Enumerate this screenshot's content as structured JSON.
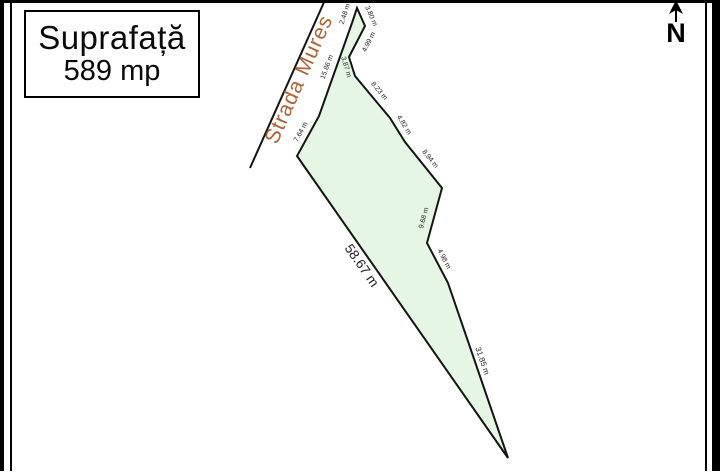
{
  "surface_box": {
    "title": "Suprafață",
    "value": "589 mp"
  },
  "street": {
    "name": "Strada Mures",
    "color": "#b06133",
    "line": {
      "x1": 250,
      "y1": 168,
      "x2": 325,
      "y2": 0
    },
    "label_pos": {
      "x": 305,
      "y": 82,
      "rot": -66,
      "size": 21
    }
  },
  "north_arrow": {
    "label": "N"
  },
  "parcel": {
    "fill": "#e5f7e4",
    "stroke": "#141414",
    "points": "357,8 365,26 349,57 355,76 390,118 405,142 442,188 427,243 448,283 508,458 297,156 319,116 352,23",
    "label_color": "#1c1c1c",
    "edge_labels": [
      {
        "text": "2.48 m",
        "x": 345,
        "y": 14,
        "rot": -72,
        "size": 7
      },
      {
        "text": "3.80 m",
        "x": 371,
        "y": 16,
        "rot": 66,
        "size": 7
      },
      {
        "text": "4.99 m",
        "x": 369,
        "y": 42,
        "rot": -63,
        "size": 7
      },
      {
        "text": "3.87 m",
        "x": 346,
        "y": 67,
        "rot": 73,
        "size": 7
      },
      {
        "text": "15.86 m",
        "x": 327,
        "y": 67,
        "rot": -70,
        "size": 7
      },
      {
        "text": "7.64 m",
        "x": 301,
        "y": 132,
        "rot": -61,
        "size": 7
      },
      {
        "text": "8.23 m",
        "x": 379,
        "y": 91,
        "rot": 50,
        "size": 7
      },
      {
        "text": "4.82 m",
        "x": 404,
        "y": 125,
        "rot": 58,
        "size": 7
      },
      {
        "text": "8.94 m",
        "x": 430,
        "y": 159,
        "rot": 51,
        "size": 7
      },
      {
        "text": "9.68 m",
        "x": 424,
        "y": 218,
        "rot": -75,
        "size": 7
      },
      {
        "text": "4.98 m",
        "x": 444,
        "y": 259,
        "rot": 62,
        "size": 7
      },
      {
        "text": "58.67 m",
        "x": 361,
        "y": 266,
        "rot": 55,
        "size": 13.5
      },
      {
        "text": "31.85 m",
        "x": 482,
        "y": 361,
        "rot": 71,
        "size": 8
      }
    ]
  }
}
